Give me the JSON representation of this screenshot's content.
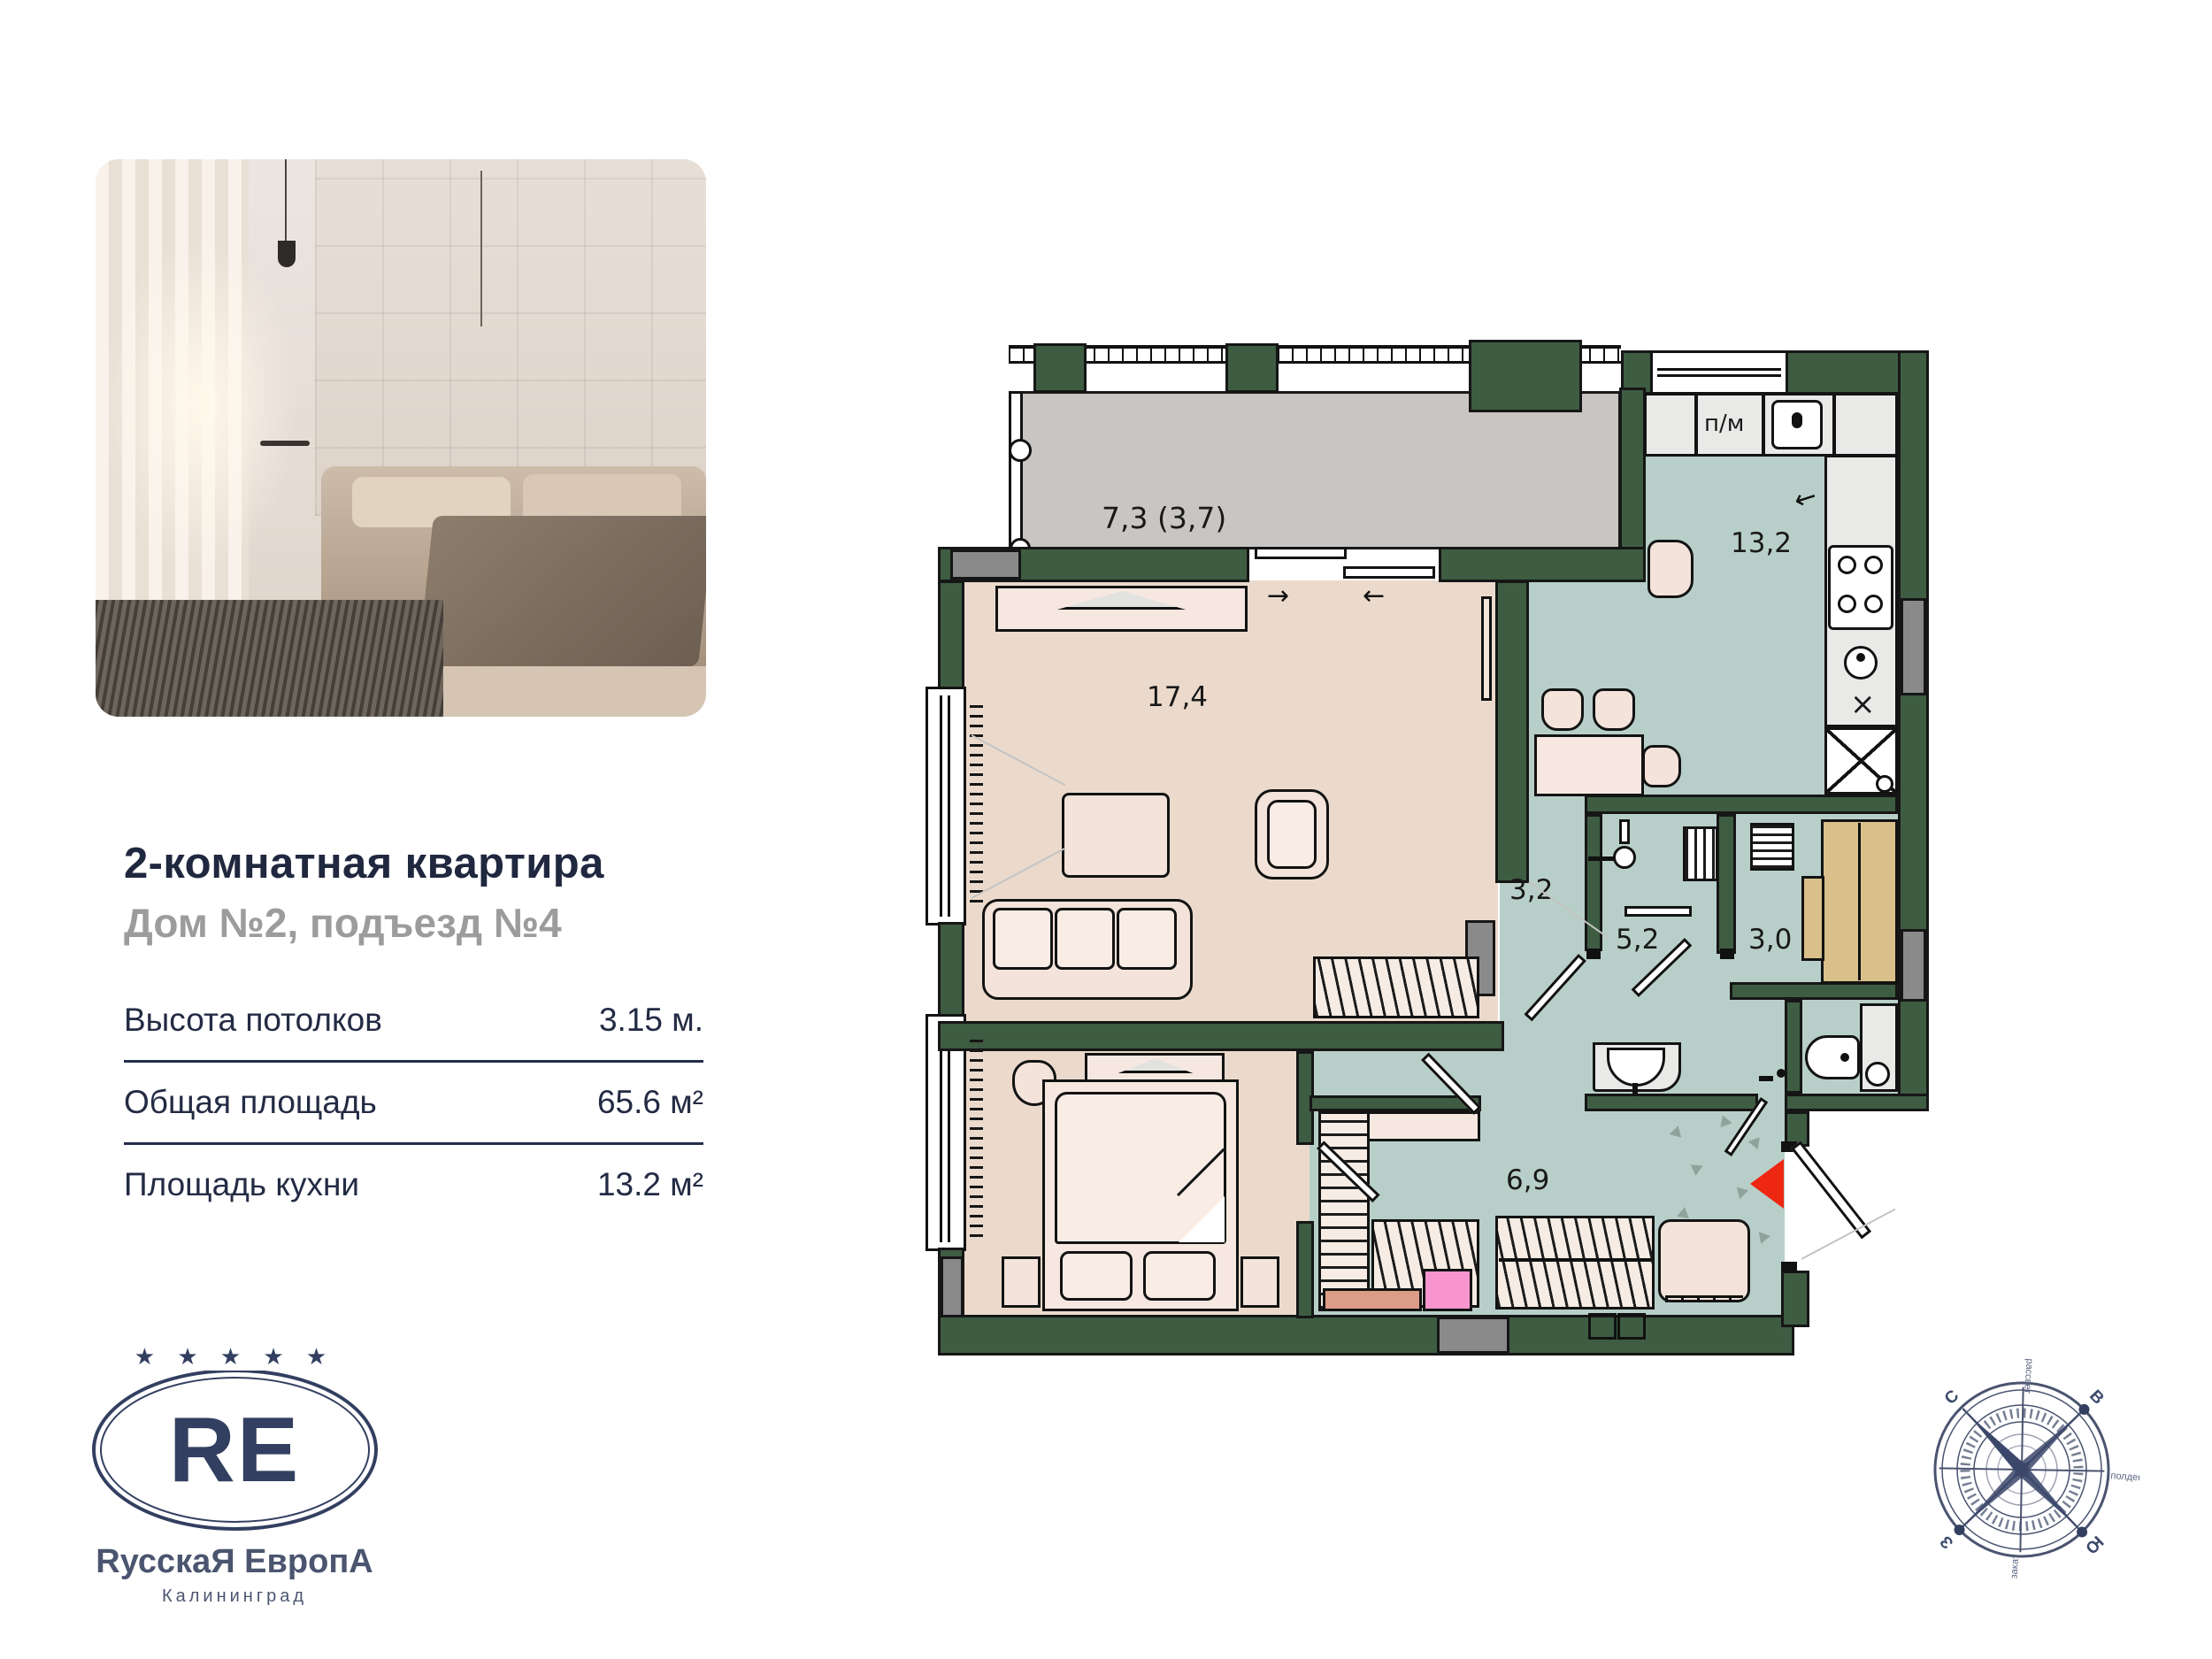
{
  "listing": {
    "title": "2-комнатная квартира",
    "subtitle": "Дом №2, подъезд №4",
    "specs": [
      {
        "label": "Высота потолков",
        "value": "3.15 м."
      },
      {
        "label": "Общая площадь",
        "value": "65.6 м²"
      },
      {
        "label": "Площадь кухни",
        "value": "13.2 м²"
      }
    ]
  },
  "logo": {
    "stars": "★ ★ ★ ★ ★",
    "monogram": "RE",
    "name": "RусскаЯ ЕвропА",
    "city": "Калининград",
    "color": "#323f60"
  },
  "floorplan": {
    "rooms": [
      {
        "id": "balcony",
        "area_label": "7,3 (3,7)"
      },
      {
        "id": "living-room",
        "area_label": "17,4"
      },
      {
        "id": "kitchen",
        "area_label": "13,2"
      },
      {
        "id": "bedroom",
        "area_label": "13,0"
      },
      {
        "id": "corridor",
        "area_label": "3,2"
      },
      {
        "id": "bathroom",
        "area_label": "5,2"
      },
      {
        "id": "sauna",
        "area_label": "3,0"
      },
      {
        "id": "hallway",
        "area_label": "6,9"
      }
    ],
    "annotations": {
      "dishwasher": "п/м",
      "slide_right": "→",
      "slide_left": "←",
      "kitchen_entry_arrow": "←",
      "oven_cross": "×"
    },
    "colors": {
      "wall": "#3e5c42",
      "floor_wood": "#ebdacc",
      "floor_tile": "#b8cfc9",
      "balcony_floor": "#c8c5c2",
      "sauna_bench": "#d9c08a",
      "entrance_marker": "#ee2712",
      "accent_pink": "#f895cf"
    }
  },
  "compass": {
    "north": "С",
    "east": "В",
    "south": "Ю",
    "west": "З",
    "dawn": "рассвет",
    "noon": "полдень",
    "sunset": "закат"
  }
}
